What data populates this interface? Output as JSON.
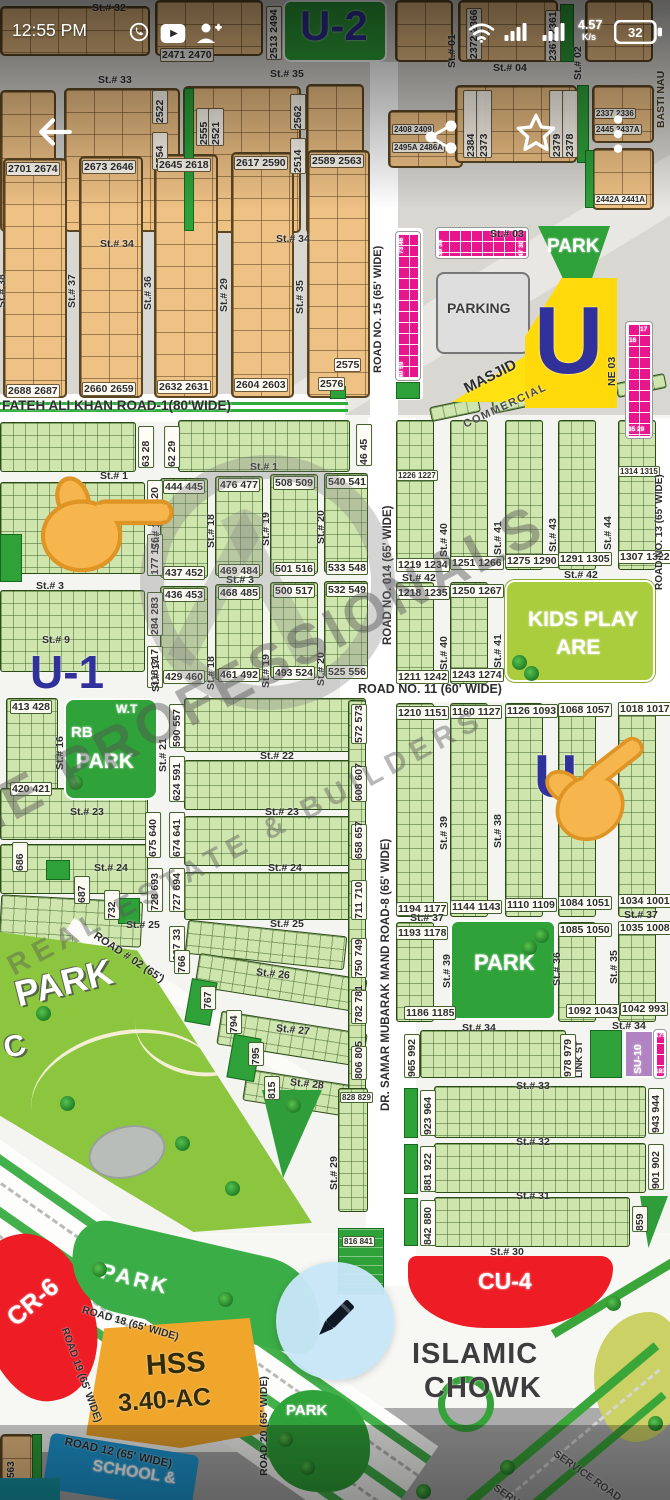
{
  "status_bar": {
    "time": "12:55 PM",
    "net_speed": "4.57",
    "net_speed_unit": "K/s",
    "battery_percent": "32"
  },
  "icons": {
    "whatsapp": "whatsapp-notification",
    "youtube": "youtube-notification",
    "person_add": "contact-add-notification",
    "wifi": "wifi",
    "signal": "cell-signal-bars",
    "battery": "battery",
    "back": "back-arrow",
    "share": "share",
    "star": "favorite-star",
    "menu": "overflow-menu",
    "pencil": "edit-pencil",
    "hand": "pointing-finger"
  },
  "watermark": {
    "line1": "THE PROFESSIONALS",
    "line2": "REAL ESTATE & BUILDERS"
  },
  "sectors": {
    "u2": "U-2",
    "u1": "U-1",
    "u_big": "U",
    "u_mid": "U"
  },
  "top": {
    "streets": {
      "st32": "St.# 32",
      "st33": "St.# 33",
      "st35": "St.# 35",
      "st04": "St.# 04",
      "st34a": "St.# 34",
      "st34b": "St.# 34",
      "st03": "St.# 03",
      "st01": "St.# 01",
      "st02": "St.# 02",
      "basti": "BASTI NAU"
    },
    "streets_v": [
      "St.# 38",
      "St.# 37",
      "St.# 36",
      "St.# 29",
      "St.# 35"
    ],
    "plots": {
      "p2513_2494": "2513 2494",
      "p2471_2470": "2471 2470",
      "p2372_2366": "2372 2366",
      "p2367_2361": "2367 2361",
      "p2522": "2522",
      "p2554": "2554",
      "p2555": "2555",
      "p2521": "2521",
      "p2562": "2562",
      "p2514": "2514",
      "p2384": "2384",
      "p2373": "2373",
      "p2379": "2379",
      "p2378": "2378",
      "p2337_2336": "2337 2336",
      "p2445_2437": "2445 2437A",
      "p2442_2441": "2442A 2441A",
      "p2408_2409": "2408 2409",
      "p2495_2486": "2495A 2486A",
      "row_top": [
        "2701 2674",
        "2673 2646",
        "2645 2618",
        "2617 2590",
        "2589 2563"
      ],
      "row_bottom": [
        "2688 2687",
        "2660 2659",
        "2632 2631",
        "2604 2603",
        "2576"
      ],
      "p2575": "2575",
      "strip_top": "73 46",
      "strip_bottom": "60 59",
      "strip_h_l": "39 38",
      "strip_h_r": "47 30",
      "strip_r_a": "17",
      "strip_r_b": "16",
      "strip_r_c": "85 29"
    },
    "areas": {
      "park": "PARK",
      "parking": "PARKING",
      "masjid": "MASJID",
      "commercial": "COMMERCIAL",
      "lane": "NE 03"
    },
    "roads": {
      "road15": "ROAD NO. 15 (65' WIDE)",
      "fateh": "FATEH ALI KHAN ROAD-1(80'WIDE)"
    }
  },
  "mid": {
    "roads": {
      "road014": "ROAD NO. 014 (65' WIDE)",
      "road11": "ROAD NO. 11 (60' WIDE)",
      "road13": "ROAD NO. 13 (65' WIDE)"
    },
    "streets": {
      "st1a": "St.# 1",
      "st1b": "St.# 1",
      "st3a": "St.# 3",
      "st3b": "St.# 3",
      "st9": "St.# 9",
      "st42a": "St.# 42",
      "st42b": "St.# 42",
      "st17a": "St.# 17",
      "st18a": "St.# 18",
      "st19a": "St.# 19",
      "st20a": "St.# 20",
      "st17b": "St.# 17",
      "st18b": "St.# 18",
      "st19b": "St.# 19",
      "st20b": "St.# 20",
      "st40a": "St.# 40",
      "st41a": "St.# 41",
      "st43": "St.# 43",
      "st44": "St.# 44",
      "st40b": "St.# 40",
      "st41b": "St.# 41"
    },
    "plots": {
      "v63": "63 28",
      "v62": "62 29",
      "v46": "46 45",
      "rowA_top": [
        "444 445",
        "476 477",
        "508 509",
        "540 541"
      ],
      "rowA_bot": [
        "437 452",
        "469 484",
        "501 516",
        "533 548"
      ],
      "rowB_top": [
        "436 453",
        "468 485",
        "500 517",
        "532 549"
      ],
      "rowB_bot": [
        "429 460",
        "461 492",
        "493 524",
        "525 556"
      ],
      "v121": "121 120",
      "v177": "177 176",
      "v284": "284 283",
      "v318": "318 317",
      "r_top": [
        "1226 1227",
        "1314 1315"
      ],
      "r_mid": [
        "1219 1234",
        "1251 1266",
        "1275 1290",
        "1291 1305",
        "1307 1322"
      ],
      "r_low": [
        "1218 1235",
        "1250 1267"
      ],
      "r_bot": [
        "1211 1242",
        "1243 1274"
      ]
    },
    "kids": {
      "l1": "KIDS PLAY",
      "l2": "ARE"
    }
  },
  "low": {
    "roads": {
      "samar": "DR. SAMAR MUBARAK MAND ROAD-8 (65' WIDE)",
      "road02": "ROAD # 02 (65')"
    },
    "streets": {
      "st16": "St.# 16",
      "st21": "St.# 21",
      "st22": "St.# 22",
      "st23a": "St.# 23",
      "st23b": "St.# 23",
      "st24a": "St.# 24",
      "st24b": "St.# 24",
      "st25a": "St.# 25",
      "st25b": "St.# 25",
      "st26": "St.# 26",
      "st27": "St.# 27",
      "st28": "St.# 28",
      "st29": "St.# 29",
      "st37a": "St.# 37",
      "st37b": "St.# 37",
      "st38": "St.# 38",
      "st39a": "St.# 39",
      "st39b": "St.# 39",
      "st36": "St.# 36",
      "st35": "St.# 35",
      "st34a": "St.# 34",
      "st34b": "St.# 34",
      "st33": "St.# 33",
      "st32": "St.# 32",
      "st31": "St.# 31",
      "st30": "St.# 30"
    },
    "park_rb": {
      "wt": "W.T",
      "rb": "RB",
      "park": "PARK"
    },
    "park_big": {
      "l1": "PARK",
      "l2": "C"
    },
    "park_mid": "PARK",
    "labels": {
      "link": "LINK ST",
      "su10": "SU-10",
      "su_a": "175",
      "su_b": "183"
    },
    "plots": {
      "p413": "413 428",
      "p420": "420 421",
      "v590": "590 557",
      "v624": "624 591",
      "v675": "675 640",
      "v674": "674 641",
      "v686": "686",
      "v687": "687",
      "v732": "732",
      "v728": "728 693",
      "v727": "727 694",
      "v667": "667 33",
      "v766": "766",
      "v767": "767",
      "v794": "794",
      "v795": "795",
      "v815": "815",
      "v572": "572 573",
      "v608": "608 607",
      "v658": "658 657",
      "v711": "711 710",
      "v750": "750 749",
      "v782": "782 781",
      "v806": "806 805",
      "p828": "828 829",
      "p816": "816 841",
      "r11t": [
        "1210 1151",
        "1160 1127",
        "1126 1093",
        "1068 1057",
        "1018 1017"
      ],
      "r11b": [
        "1194 1177",
        "1144 1143",
        "1110 1109",
        "1084 1051",
        "1034 1001"
      ],
      "r37": [
        "1193 1178",
        "1085 1050",
        "1035 1008"
      ],
      "p1186": "1186 1185",
      "p1092": "1092 1043",
      "p1042": "1042 993",
      "v965": "965 992",
      "v978": "978 979",
      "v923": "923 964",
      "v943": "943 944",
      "v881": "881 922",
      "v901": "901 902",
      "v842": "842 880",
      "v859": "859"
    }
  },
  "bottom": {
    "areas": {
      "cu4": "CU-4",
      "cr6": "CR-6",
      "hss1": "HSS",
      "hss2": "3.40-AC",
      "school": "SCHOOL &",
      "park_a": "PARK",
      "park_b": "PARK",
      "chowk1": "ISLAMIC",
      "chowk2": "CHOWK",
      "p563": "563"
    },
    "roads": {
      "r18": "ROAD 18 (65' WIDE)",
      "r19": "ROAD 19 (65' WIDE)",
      "r20": "ROAD 20 (65' WIDE)",
      "r12": "ROAD 12 (65' WIDE)",
      "service_a": "SERVICE ROAD",
      "service_b": "SERVICE ROAD"
    }
  },
  "colors": {
    "plot_tan": "#eec185",
    "plot_green": "#cfe5ae",
    "commercial_pink": "#e8158d",
    "sector_blue": "#31319b",
    "red": "#ee1c25",
    "masjid_yellow": "#ffd90a",
    "school_blue": "#1e9ad6",
    "su10_purple": "#b183c2",
    "park_green": "#8cc63f",
    "kids_green": "#aacd3e",
    "hss_orange": "#f0a62b",
    "fab_blue": "#cde9f8"
  }
}
